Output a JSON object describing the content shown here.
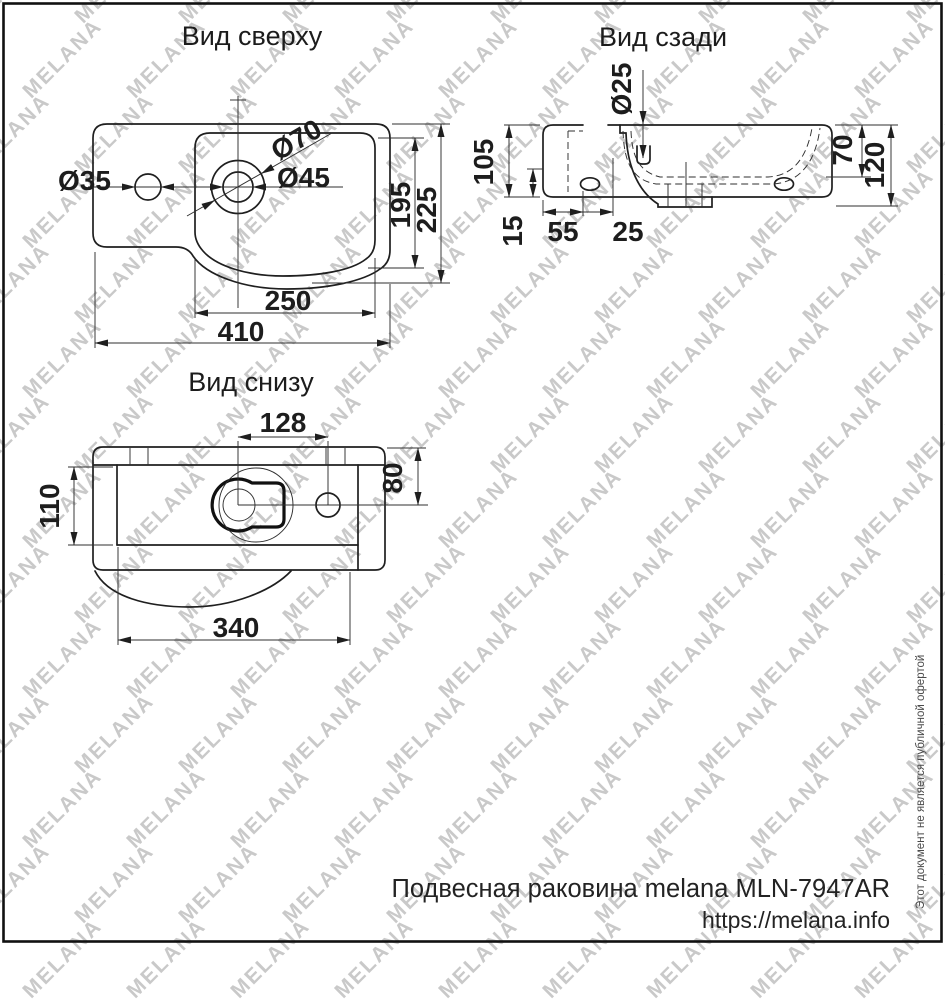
{
  "style": {
    "ink_color": "#1f1f1f",
    "watermark_color": "#c9c9c9",
    "background": "#ffffff"
  },
  "watermark": {
    "text": "MELANA"
  },
  "views": {
    "top": {
      "title": "Вид сверху",
      "dims": {
        "side_hole_diameter": "Ø35",
        "recess_diameter": "Ø70",
        "faucet_hole_diameter": "Ø45",
        "bowl_depth": "195",
        "total_depth": "225",
        "bowl_width": "250",
        "total_width": "410"
      }
    },
    "back": {
      "title": "Вид сзади",
      "dims": {
        "overflow_diameter": "Ø25",
        "back_height": "105",
        "rim_height": "15",
        "slot_offset": "55",
        "slot_width": "25",
        "inner_depth": "70",
        "total_height": "120"
      }
    },
    "bottom": {
      "title": "Вид снизу",
      "dims": {
        "hole_spacing": "128",
        "side_hole_offset": "80",
        "base_depth": "110",
        "base_width": "340"
      }
    }
  },
  "footer": {
    "product_label": "Подвесная раковина melana MLN-7947AR",
    "website": "https://melana.info",
    "disclaimer": "Этот документ не является публичной офертой"
  }
}
